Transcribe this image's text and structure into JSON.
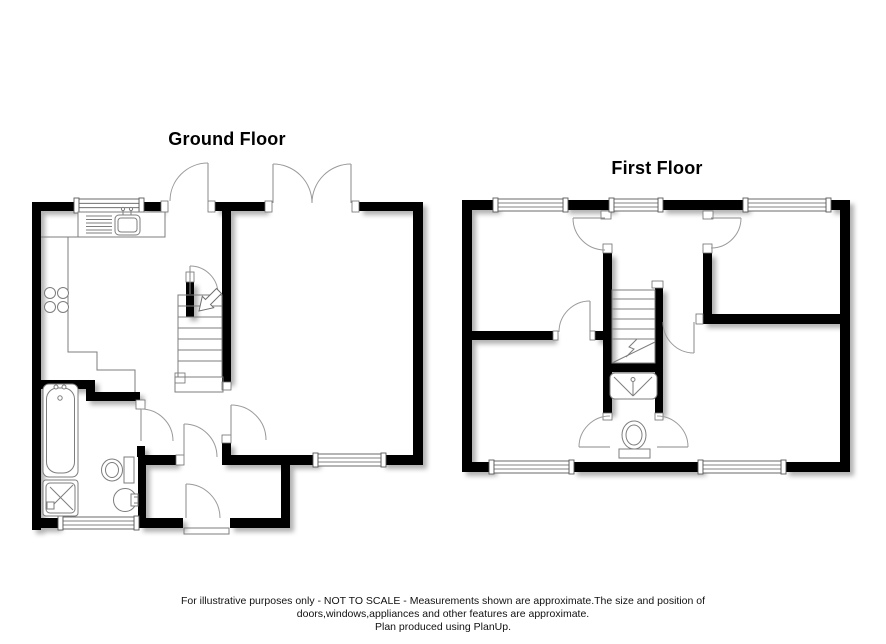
{
  "plans": [
    {
      "id": "ground-floor",
      "title": "Ground Floor",
      "fixtures": [
        "kitchen-sink",
        "hob",
        "staircase",
        "bathtub",
        "shower-tray",
        "toilet",
        "wash-basin"
      ]
    },
    {
      "id": "first-floor",
      "title": "First Floor",
      "fixtures": [
        "staircase",
        "shower-cubicle",
        "toilet"
      ]
    }
  ],
  "footer": {
    "lines": [
      "For illustrative purposes only - NOT TO SCALE - Measurements shown are approximate.The size and position of",
      "doors,windows,appliances and other features are approximate.",
      "Plan produced using PlanUp."
    ]
  },
  "colors": {
    "wall": "#000000",
    "thin_line": "#7d7d7d",
    "door_arc": "#9a9a9a",
    "background": "#ffffff",
    "text": "#000000"
  }
}
